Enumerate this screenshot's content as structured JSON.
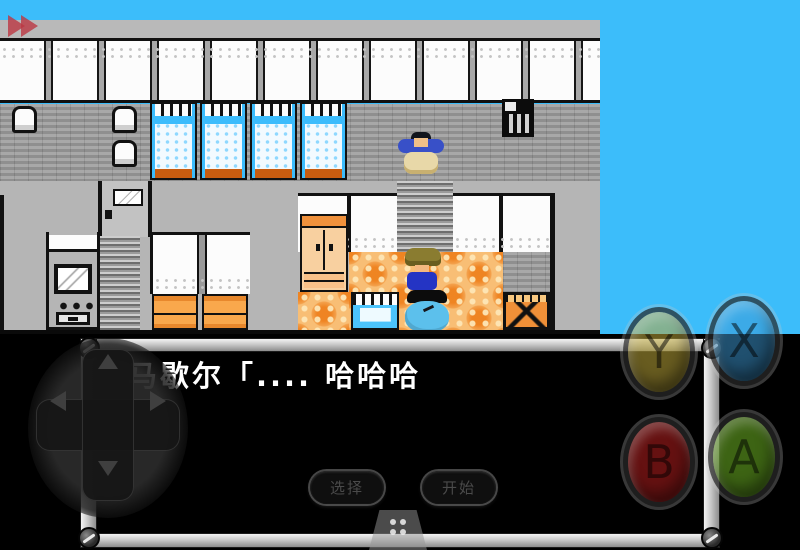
{
  "game": {
    "dialog_text": "马歇尔「.... 哈哈哈"
  },
  "controls": {
    "fast_forward_icon": "fast-forward",
    "dpad_arrows": [
      "up",
      "down",
      "left",
      "right"
    ],
    "action_buttons": [
      {
        "label": "Y",
        "color": "#bea83a"
      },
      {
        "label": "X",
        "color": "#3e9ad4"
      },
      {
        "label": "B",
        "color": "#a81c1c"
      },
      {
        "label": "A",
        "color": "#66a622"
      }
    ],
    "select_label": "选择",
    "start_label": "开始",
    "pause_icon": "drag-handle-dots"
  },
  "colors": {
    "sky": "#3cbdfa",
    "building_gray": "#b5b5b5",
    "bed_blue": "#3cbcfc",
    "carpet_orange": "#f8be75",
    "furniture_orange": "#f9a84c",
    "dialog_frame_silver": "#c9c9c9",
    "dialog_background": "#000000",
    "dialog_text_color": "#ffffff"
  }
}
